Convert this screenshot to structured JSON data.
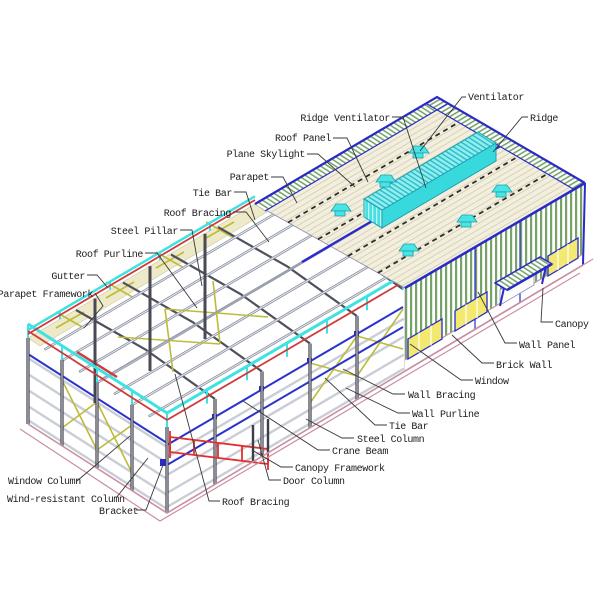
{
  "diagram": {
    "type": "steel-structure-building-annotated-diagram",
    "labels": {
      "ventilator": "Ventilator",
      "ridge": "Ridge",
      "ridge_ventilator": "Ridge Ventilator",
      "roof_panel": "Roof Panel",
      "plane_skylight": "Plane Skylight",
      "parapet": "Parapet",
      "tie_bar_roof": "Tie Bar",
      "roof_bracing_top": "Roof Bracing",
      "steel_pillar": "Steel Pillar",
      "roof_purline": "Roof Purline",
      "gutter": "Gutter",
      "parapet_framework": "Parapet Framework",
      "window_column": "Window Column",
      "wind_resistant_column": "Wind-resistant Column",
      "bracket": "Bracket",
      "roof_bracing_bottom": "Roof Bracing",
      "door_column": "Door Column",
      "canopy_framework": "Canopy Framework",
      "crane_beam": "Crane Beam",
      "steel_column": "Steel Column",
      "tie_bar_wall": "Tie Bar",
      "wall_purline": "Wall Purline",
      "wall_bracing": "Wall Bracing",
      "window": "Window",
      "brick_wall": "Brick Wall",
      "wall_panel": "Wall Panel",
      "canopy": "Canopy"
    },
    "colors": {
      "background": "#ffffff",
      "leader_line": "#3a3a3a",
      "steel_dark": "#3e3e4a",
      "steel_gray": "#8d93a2",
      "cyan_accent": "#3fe2e2",
      "blue_accent": "#2a2ac8",
      "red_accent": "#d13a3a",
      "pink_base": "#c990a4",
      "wall_green": "#76a368",
      "window_yellow": "#f3e971",
      "bracing_olive": "#bcbc3a",
      "roof_cream": "#f3efdf"
    }
  }
}
